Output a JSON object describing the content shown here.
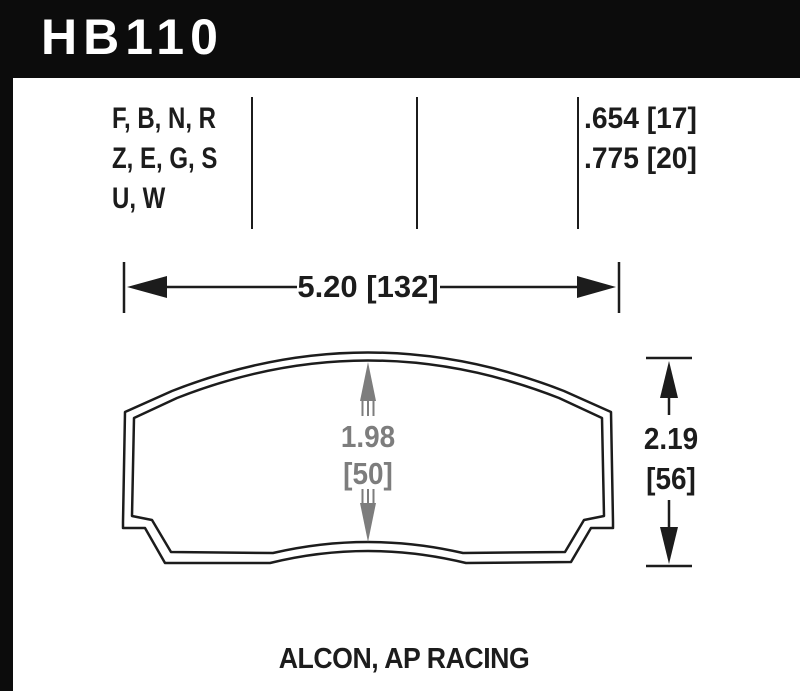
{
  "header": {
    "part_number": "HB110"
  },
  "spec_table": {
    "compound_codes": [
      "F, B, N, R",
      "Z, E, G, S",
      "U, W"
    ],
    "thickness_values": [
      ".654 [17]",
      ".775 [20]"
    ]
  },
  "dimensions": {
    "overall_width": "5.20 [132]",
    "pad_height_in": "1.98",
    "pad_height_mm": "[50]",
    "overall_height_in": "2.19",
    "overall_height_mm": "[56]"
  },
  "footer": {
    "applications": "ALCON, AP RACING"
  },
  "colors": {
    "bar_black": "#0c0c0c",
    "ink": "#1c1c1c",
    "dim_gray": "#7d7d7d",
    "background": "#ffffff"
  }
}
